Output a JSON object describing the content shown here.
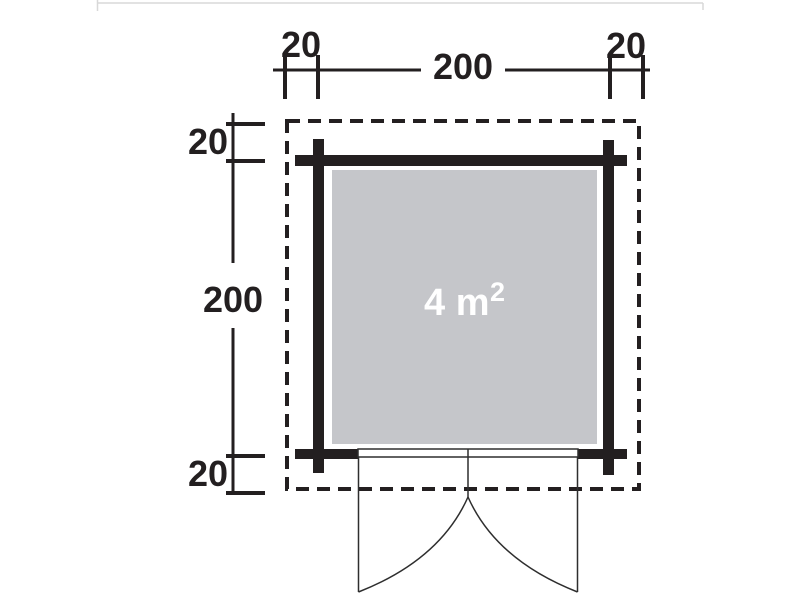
{
  "diagram": {
    "type": "shed-floor-plan",
    "top_dimensions": {
      "left_offset": "20",
      "total": "200",
      "right_offset": "20"
    },
    "left_dimensions": {
      "top_offset": "20",
      "total": "200",
      "bottom_offset": "20"
    },
    "floor_area": {
      "value": "4 m",
      "superscript": "2",
      "display": "4 m²"
    },
    "colors": {
      "line": "#231f20",
      "floor_fill": "#c5c6ca",
      "area_text": "#ffffff",
      "page_edge": "#d8d8d8"
    }
  }
}
